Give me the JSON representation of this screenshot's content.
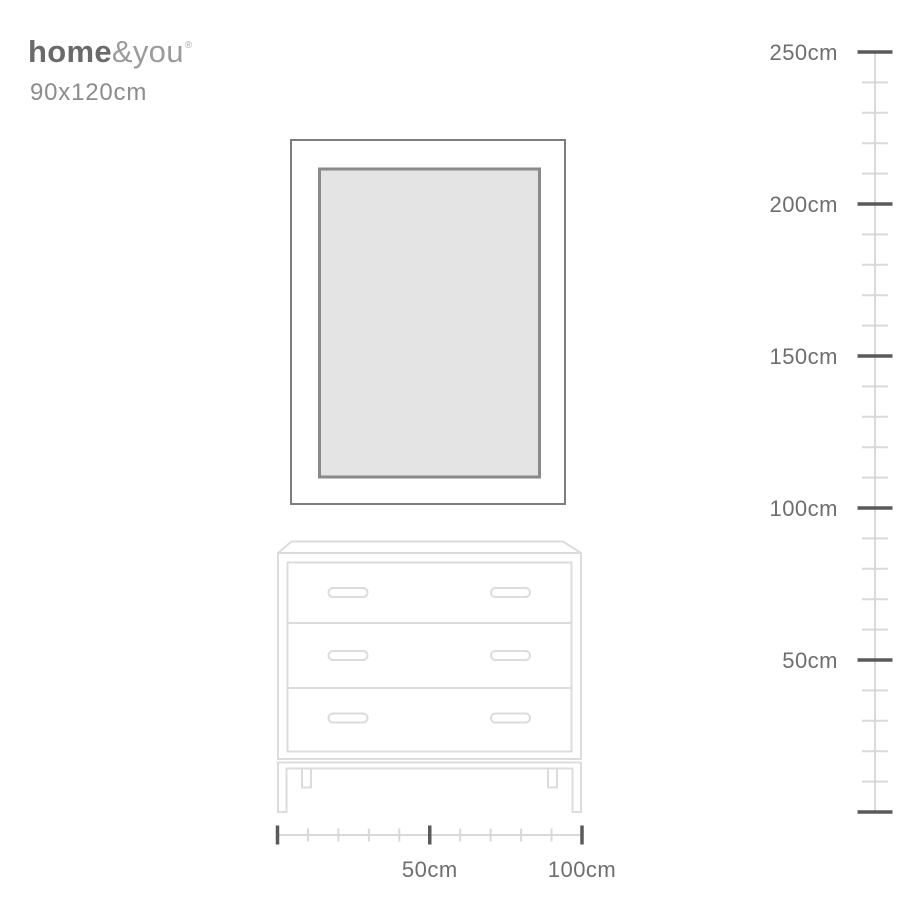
{
  "brand": {
    "logo_bold": "home",
    "logo_light": "&you",
    "registered_mark": "®",
    "product_size": "90x120cm"
  },
  "colors": {
    "background": "#ffffff",
    "logo_bold_text": "#6a6a6a",
    "logo_light_text": "#9b9b9b",
    "size_text": "#8c8c8c",
    "frame_border": "#7e7e7e",
    "mirror_border": "#8a8a8a",
    "mirror_fill": "#e4e4e4",
    "furniture_line": "#dcdcdc",
    "ruler_line": "#d9d9d9",
    "ruler_major_tick": "#5a5a5a",
    "ruler_label": "#6e6e6e"
  },
  "scene": {
    "items": [
      "mirror-frame",
      "dresser-with-three-drawers"
    ],
    "mirror_width_cm": 90,
    "mirror_height_cm": 120,
    "drawer_count": 3
  },
  "vertical_ruler": {
    "unit": "cm",
    "minor_step": 10,
    "ticks": [
      {
        "value": 250,
        "label": "250cm"
      },
      {
        "value": 200,
        "label": "200cm"
      },
      {
        "value": 150,
        "label": "150cm"
      },
      {
        "value": 100,
        "label": "100cm"
      },
      {
        "value": 50,
        "label": "50cm"
      },
      {
        "value": 0,
        "label": ""
      }
    ]
  },
  "horizontal_ruler": {
    "unit": "cm",
    "minor_step": 10,
    "ticks": [
      {
        "value": 0,
        "label": ""
      },
      {
        "value": 50,
        "label": "50cm"
      },
      {
        "value": 100,
        "label": "100cm"
      }
    ]
  }
}
